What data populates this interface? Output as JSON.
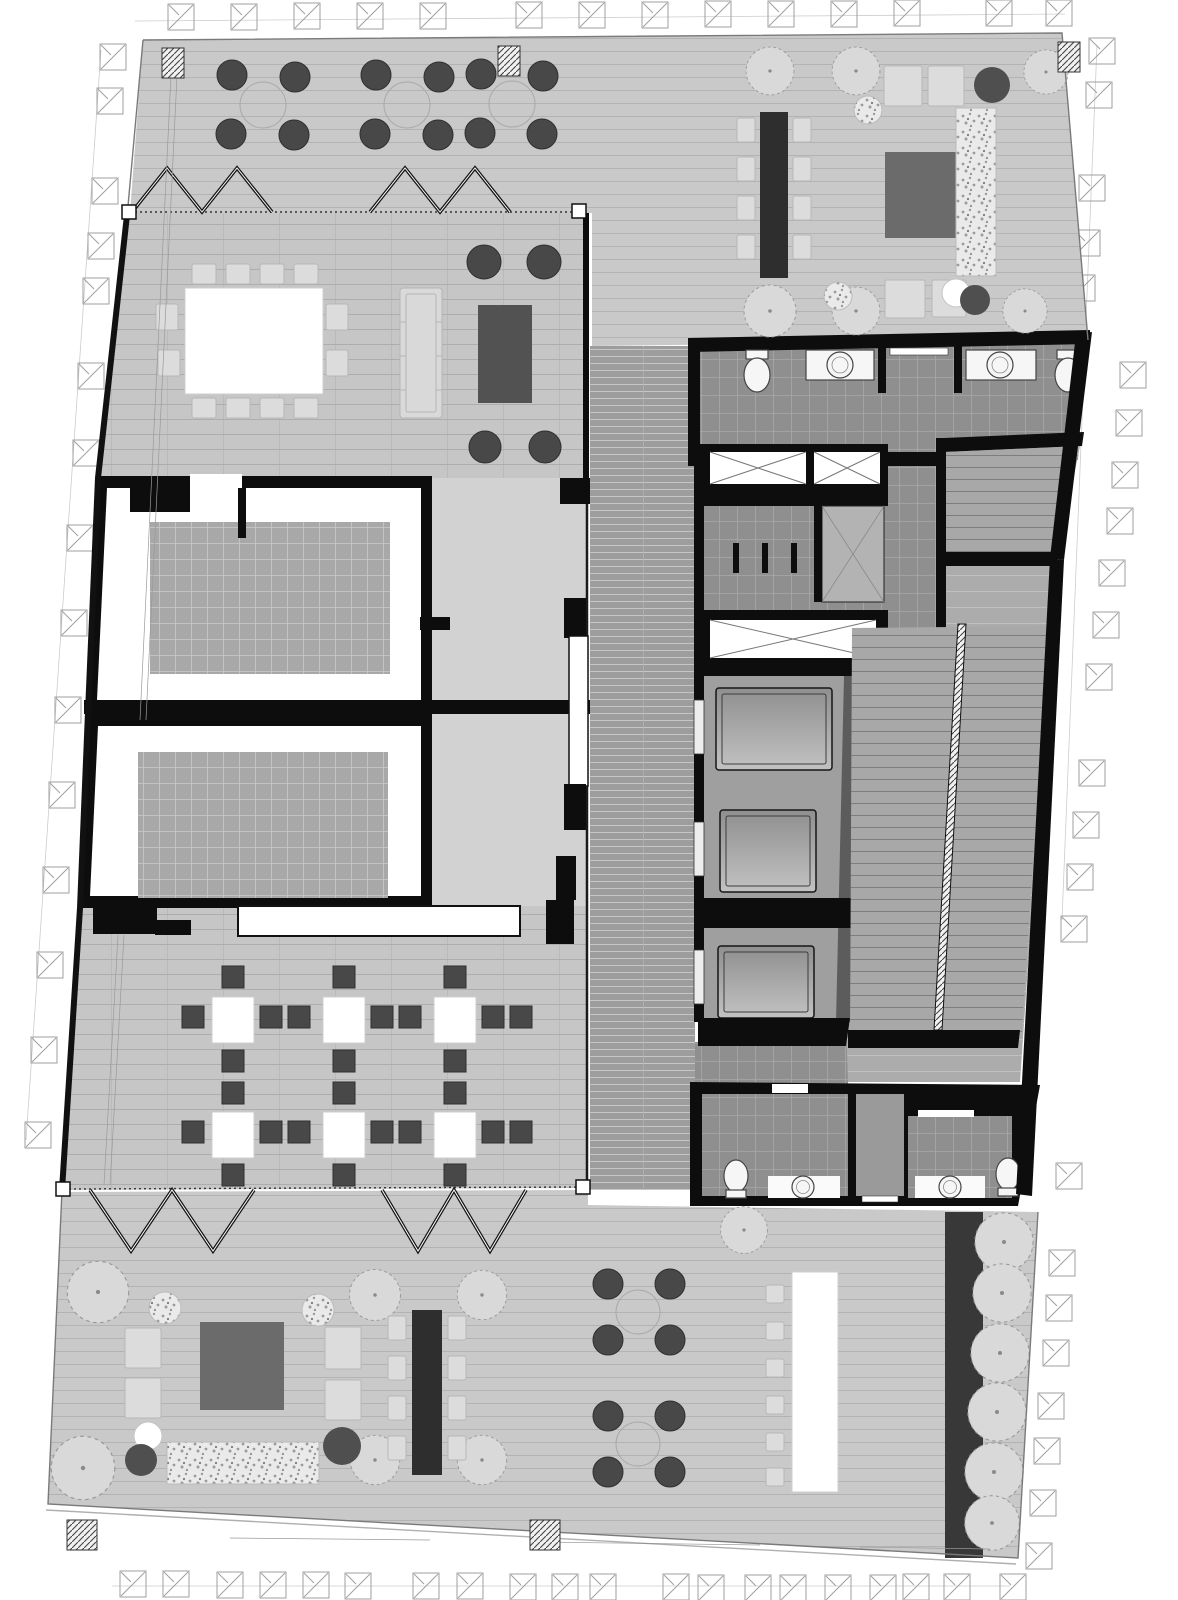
{
  "figure": {
    "type": "architectural-floor-plan",
    "view": "top-down presentation plan",
    "style": "grayscale rendered plan, no text annotations visible"
  },
  "palette": {
    "white": "#ffffff",
    "wall": "#0d0d0d",
    "plan_outline": "#7a7a7a",
    "context_symbol": "#9f9f9f",
    "deck": "#c9c9c9",
    "deck_line": "#b3b3b3",
    "floor_main": "#c6c6c6",
    "floor_line": "#adadad",
    "corridor_west": "#d2d2d2",
    "core_strip": "#9d9d9d",
    "core_strip_line": "#c6c6c6",
    "tile": "#8f8f8f",
    "tile_line": "#a8a8a8",
    "lobby": "#acacac",
    "lobby_line": "#c0c0c0",
    "stair_floor": "#a8a8a8",
    "stair_tread": "#7e7e7e",
    "carpet": "#a8a8a8",
    "carpet_line": "#c9c9c9",
    "room_floor": "#ffffff",
    "table_white": "#ffffff",
    "table_dark": "#2e2e2e",
    "chair_light": "#dcdcdc",
    "chair_light_edge": "#b7b7b7",
    "chair_dark": "#484848",
    "chair_dark_edge": "#2f2f2f",
    "sofa": "#d9d9d9",
    "rug_dark": "#6b6b6b",
    "coffee_table": "#525252",
    "pouf_dark": "#4f4f4f",
    "tree_fill": "#d9d9d9",
    "tree_edge": "#9a9a9a",
    "gravel_bg": "#eaeaea",
    "gravel_dot": "#9b9b9b",
    "planter_dark": "#383838",
    "elevator_shaft": "#9f9f9f",
    "elevator_shadow": "#5c5c5c",
    "elevator_car_a": "#8f8f8f",
    "elevator_car_b": "#c2c2c2",
    "fixture": "#f6f6f6",
    "fixture_edge": "#444444",
    "zigzag": "#151515"
  },
  "zones": [
    {
      "name": "north-terrace",
      "kind": "outdoor roof deck",
      "furniture": {
        "cafe_tables": 3,
        "chairs_per_cafe_table": 4,
        "communal_table_seats": 8,
        "lounge_chairs": 4,
        "poufs": 3,
        "trees": 6,
        "gravel_planters": 3,
        "area_rug": 1,
        "hatched_columns": 2
      }
    },
    {
      "name": "conference-room",
      "kind": "meeting room behind folding glass wall",
      "furniture": {
        "conference_table_seats": 12,
        "sofa": 1,
        "coffee_table": 1,
        "round_lounge_chairs": 4
      }
    },
    {
      "name": "meeting-room-a",
      "kind": "enclosed room with inset carpet",
      "furniture": {
        "carpet": 1
      }
    },
    {
      "name": "meeting-room-b",
      "kind": "enclosed room with inset carpet",
      "furniture": {
        "carpet": 1
      }
    },
    {
      "name": "workshop-room",
      "kind": "flexible seating room",
      "furniture": {
        "square_tables": 6,
        "dark_chairs": 32
      }
    },
    {
      "name": "service-core",
      "kind": "core",
      "elements": {
        "elevators": 3,
        "crossed_service_shafts": 4,
        "stairs": 2,
        "wc_toilets_upper": 2,
        "wc_sinks_upper": 2,
        "wc_toilets_lower": 2,
        "wc_sinks_lower": 2
      }
    },
    {
      "name": "east-lobby",
      "kind": "elevator lobby with wide stair"
    },
    {
      "name": "south-terrace",
      "kind": "outdoor roof deck",
      "furniture": {
        "lounge_rug": 1,
        "lounge_chairs": 4,
        "poufs": 4,
        "round_dining_tables": 2,
        "communal_table_seats": 8,
        "bar_counter": 1,
        "bar_stools": 6,
        "trees": 13,
        "gravel_planters": 3,
        "planter_strip": 1,
        "hatched_columns": 2
      }
    }
  ],
  "context": {
    "column_grid_symbols": "crossed squares around the building perimeter",
    "count_estimate": 60
  }
}
